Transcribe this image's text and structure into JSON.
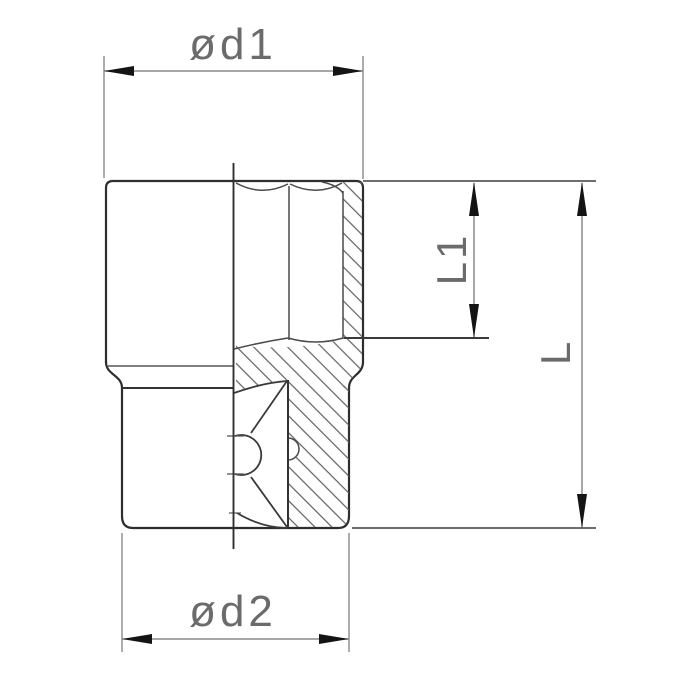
{
  "drawing": {
    "title": "socket-wrench-cross-section",
    "dimensions": {
      "d1": "ød1",
      "d2": "ød2",
      "l1": "L1",
      "l": "L"
    },
    "colors": {
      "background": "#ffffff",
      "outline": "#2e2e2e",
      "interior_lines": "#4a4a4a",
      "hatch": "#606060",
      "dimension_lines": "#8a8a8a",
      "arrowheads": "#141414",
      "label_text": "#6b6b6b"
    }
  }
}
